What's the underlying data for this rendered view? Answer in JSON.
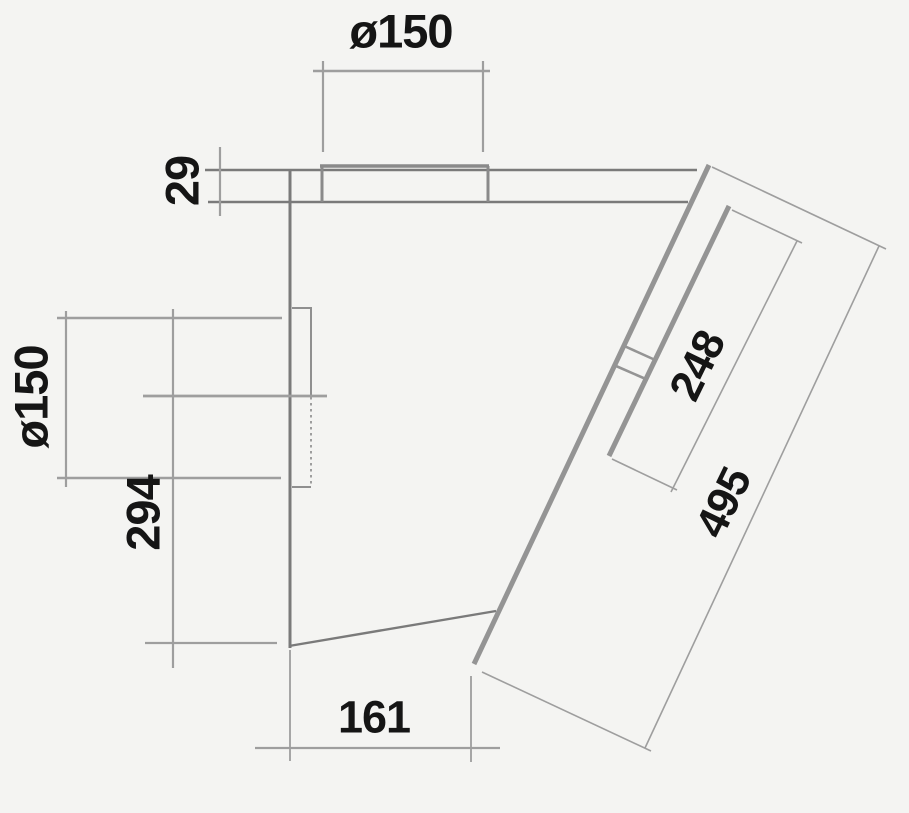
{
  "drawing": {
    "background_color": "#f4f4f2",
    "outline_color": "#7a7a7a",
    "panel_color": "#949494",
    "dimension_color": "#9e9e9e",
    "text_color": "#151515",
    "dimensions": {
      "top_duct_diameter": "ø150",
      "top_plate_thickness": "29",
      "rear_duct_diameter": "ø150",
      "rear_lower_height": "294",
      "bottom_depth": "161",
      "glass_panel_length": "248",
      "front_panel_length": "495"
    }
  }
}
